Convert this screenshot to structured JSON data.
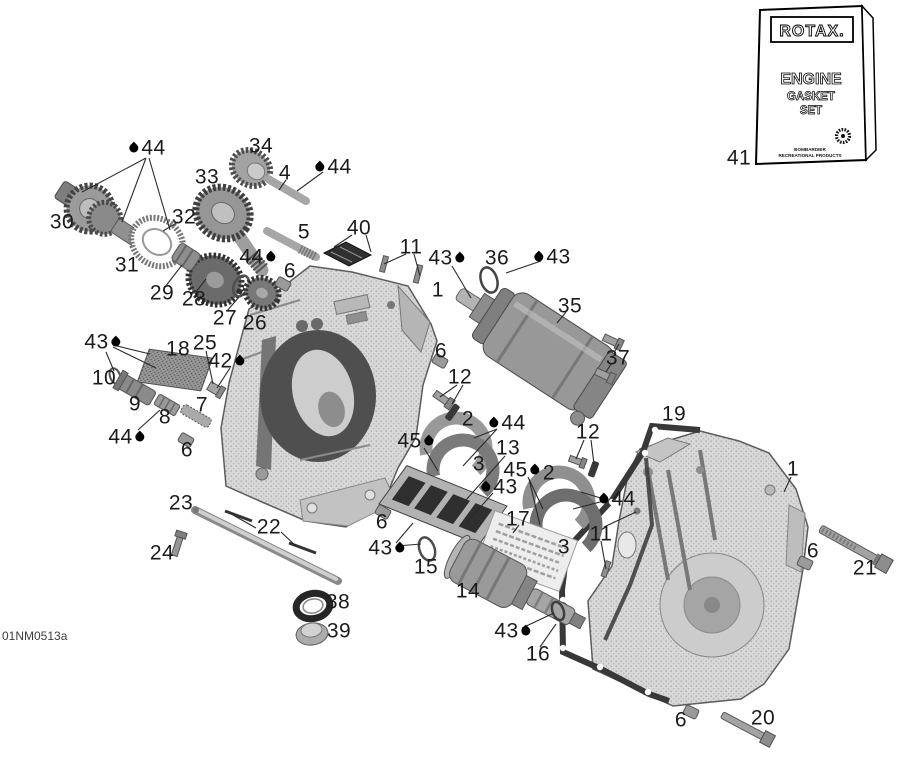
{
  "meta": {
    "drawing_code": "01NM0513a"
  },
  "gasket_box": {
    "brand": "ROTAX.",
    "line1": "ENGINE",
    "line2": "GASKET",
    "line3": "SET",
    "footer1": "BOMBARDIER",
    "footer2": "RECREATIONAL PRODUCTS"
  },
  "colors": {
    "line": "#2a2a2a",
    "label": "#1b1b1b",
    "case_light": "#d8d8d8",
    "part_dark": "#3c3c3c",
    "paper": "#ffffff"
  },
  "callouts": [
    {
      "num": "44",
      "x": 146,
      "y": 148,
      "drop": "left"
    },
    {
      "num": "30",
      "x": 62,
      "y": 222
    },
    {
      "num": "33",
      "x": 207,
      "y": 177
    },
    {
      "num": "34",
      "x": 261,
      "y": 146
    },
    {
      "num": "4",
      "x": 285,
      "y": 173
    },
    {
      "num": "44",
      "x": 332,
      "y": 167,
      "drop": "left"
    },
    {
      "num": "32",
      "x": 184,
      "y": 217
    },
    {
      "num": "31",
      "x": 127,
      "y": 265
    },
    {
      "num": "29",
      "x": 162,
      "y": 293
    },
    {
      "num": "28",
      "x": 194,
      "y": 299
    },
    {
      "num": "27",
      "x": 225,
      "y": 318
    },
    {
      "num": "26",
      "x": 255,
      "y": 323
    },
    {
      "num": "5",
      "x": 304,
      "y": 232
    },
    {
      "num": "40",
      "x": 359,
      "y": 228
    },
    {
      "num": "44",
      "x": 259,
      "y": 257,
      "drop": "right"
    },
    {
      "num": "6",
      "x": 290,
      "y": 271
    },
    {
      "num": "11",
      "x": 411,
      "y": 247
    },
    {
      "num": "43",
      "x": 448,
      "y": 258,
      "drop": "right"
    },
    {
      "num": "36",
      "x": 497,
      "y": 258
    },
    {
      "num": "43",
      "x": 551,
      "y": 257,
      "drop": "left"
    },
    {
      "num": "35",
      "x": 570,
      "y": 306
    },
    {
      "num": "37",
      "x": 618,
      "y": 358
    },
    {
      "num": "1",
      "x": 438,
      "y": 290
    },
    {
      "num": "43",
      "x": 104,
      "y": 342,
      "drop": "right"
    },
    {
      "num": "18",
      "x": 178,
      "y": 349
    },
    {
      "num": "25",
      "x": 205,
      "y": 343
    },
    {
      "num": "42",
      "x": 228,
      "y": 361,
      "drop": "right"
    },
    {
      "num": "10",
      "x": 104,
      "y": 378
    },
    {
      "num": "9",
      "x": 135,
      "y": 404
    },
    {
      "num": "8",
      "x": 165,
      "y": 417
    },
    {
      "num": "7",
      "x": 202,
      "y": 405
    },
    {
      "num": "44",
      "x": 128,
      "y": 437,
      "drop": "right"
    },
    {
      "num": "6",
      "x": 187,
      "y": 450
    },
    {
      "num": "6",
      "x": 441,
      "y": 351
    },
    {
      "num": "12",
      "x": 460,
      "y": 377
    },
    {
      "num": "2",
      "x": 468,
      "y": 419
    },
    {
      "num": "44",
      "x": 506,
      "y": 423,
      "drop": "left"
    },
    {
      "num": "45",
      "x": 417,
      "y": 441,
      "drop": "right"
    },
    {
      "num": "3",
      "x": 479,
      "y": 464
    },
    {
      "num": "13",
      "x": 508,
      "y": 448
    },
    {
      "num": "45",
      "x": 523,
      "y": 470,
      "drop": "right"
    },
    {
      "num": "2",
      "x": 549,
      "y": 473
    },
    {
      "num": "12",
      "x": 588,
      "y": 432
    },
    {
      "num": "43",
      "x": 498,
      "y": 487,
      "drop": "left"
    },
    {
      "num": "17",
      "x": 518,
      "y": 519
    },
    {
      "num": "19",
      "x": 674,
      "y": 414
    },
    {
      "num": "44",
      "x": 616,
      "y": 499,
      "drop": "left"
    },
    {
      "num": "11",
      "x": 601,
      "y": 534
    },
    {
      "num": "3",
      "x": 564,
      "y": 547
    },
    {
      "num": "1",
      "x": 793,
      "y": 469
    },
    {
      "num": "6",
      "x": 813,
      "y": 551
    },
    {
      "num": "21",
      "x": 865,
      "y": 568
    },
    {
      "num": "23",
      "x": 181,
      "y": 503
    },
    {
      "num": "22",
      "x": 269,
      "y": 527
    },
    {
      "num": "24",
      "x": 162,
      "y": 553
    },
    {
      "num": "38",
      "x": 338,
      "y": 602
    },
    {
      "num": "39",
      "x": 339,
      "y": 631
    },
    {
      "num": "6",
      "x": 382,
      "y": 522
    },
    {
      "num": "43",
      "x": 388,
      "y": 548,
      "drop": "right"
    },
    {
      "num": "15",
      "x": 426,
      "y": 567
    },
    {
      "num": "14",
      "x": 468,
      "y": 591
    },
    {
      "num": "43",
      "x": 514,
      "y": 631,
      "drop": "right"
    },
    {
      "num": "16",
      "x": 538,
      "y": 654
    },
    {
      "num": "6",
      "x": 681,
      "y": 720
    },
    {
      "num": "20",
      "x": 763,
      "y": 718
    },
    {
      "num": "41",
      "x": 739,
      "y": 158
    }
  ],
  "leader_lines": [
    [
      146,
      158,
      82,
      192
    ],
    [
      146,
      158,
      122,
      222
    ],
    [
      149,
      158,
      170,
      230
    ],
    [
      286,
      180,
      279,
      190
    ],
    [
      323,
      172,
      297,
      191
    ],
    [
      352,
      235,
      334,
      247
    ],
    [
      366,
      235,
      371,
      252
    ],
    [
      406,
      254,
      384,
      264
    ],
    [
      414,
      254,
      420,
      276
    ],
    [
      452,
      266,
      471,
      298
    ],
    [
      541,
      261,
      506,
      273
    ],
    [
      566,
      312,
      557,
      323
    ],
    [
      615,
      351,
      619,
      344
    ],
    [
      611,
      364,
      606,
      372
    ],
    [
      791,
      477,
      784,
      492
    ],
    [
      457,
      385,
      440,
      397
    ],
    [
      463,
      385,
      452,
      404
    ],
    [
      497,
      429,
      474,
      438
    ],
    [
      497,
      429,
      463,
      466
    ],
    [
      424,
      448,
      438,
      471
    ],
    [
      505,
      456,
      466,
      500
    ],
    [
      493,
      493,
      467,
      522
    ],
    [
      519,
      525,
      513,
      533
    ],
    [
      528,
      477,
      543,
      509
    ],
    [
      529,
      479,
      540,
      525
    ],
    [
      584,
      440,
      576,
      459
    ],
    [
      591,
      440,
      594,
      464
    ],
    [
      604,
      499,
      581,
      492
    ],
    [
      604,
      501,
      573,
      509
    ],
    [
      604,
      527,
      636,
      512
    ],
    [
      601,
      541,
      606,
      569
    ],
    [
      113,
      345,
      150,
      354
    ],
    [
      113,
      347,
      156,
      368
    ],
    [
      106,
      352,
      114,
      371
    ],
    [
      206,
      351,
      213,
      384
    ],
    [
      230,
      368,
      217,
      388
    ],
    [
      165,
      287,
      182,
      265
    ],
    [
      227,
      311,
      239,
      297
    ],
    [
      196,
      292,
      206,
      279
    ],
    [
      138,
      430,
      160,
      410
    ],
    [
      256,
      528,
      233,
      515
    ],
    [
      281,
      532,
      296,
      546
    ],
    [
      396,
      543,
      413,
      523
    ],
    [
      397,
      546,
      421,
      544
    ],
    [
      522,
      628,
      554,
      613
    ],
    [
      540,
      647,
      556,
      624
    ],
    [
      178,
      222,
      163,
      231
    ]
  ]
}
